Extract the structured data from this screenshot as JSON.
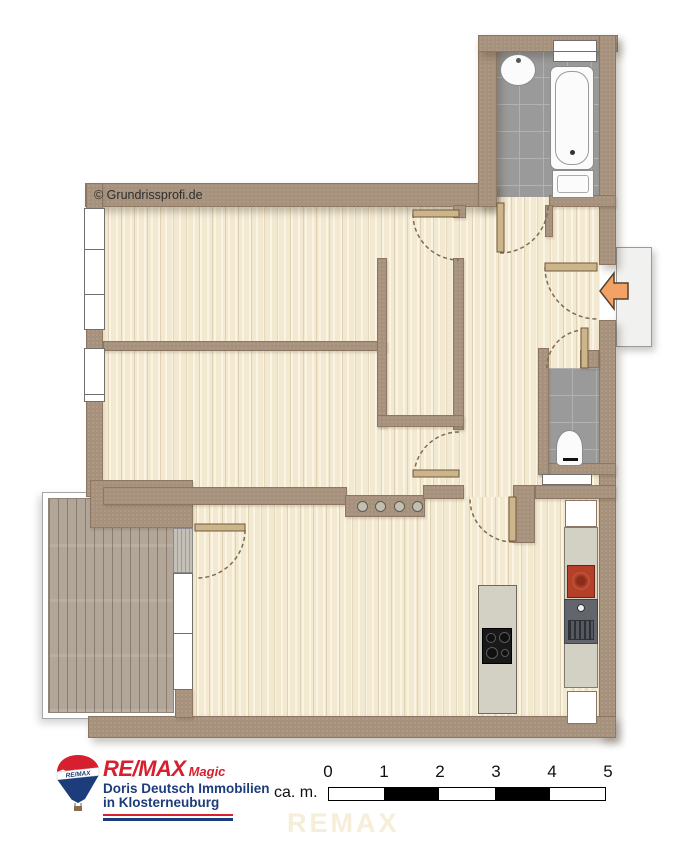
{
  "plan": {
    "copyright_watermark": "© Grundrissprofi.de"
  },
  "footer": {
    "logo": {
      "brand": "RE/MAX",
      "suffix": "Magic",
      "line1": "Doris Deutsch Immobilien",
      "line2": "in Klosterneuburg",
      "balloon_label": "RE/MAX"
    },
    "scale_bar": {
      "unit_label": "ca. m.",
      "tick_labels": [
        "0",
        "1",
        "2",
        "3",
        "4",
        "5"
      ],
      "segment_colors": [
        "#ffffff",
        "#000000",
        "#ffffff",
        "#000000",
        "#ffffff"
      ]
    },
    "background_watermark": "REMAX"
  },
  "colors": {
    "wall": "#a6917c",
    "floor_wood": "#f3e9d1",
    "tile_floor": "#9a9a9a",
    "balcony_deck": "#b1a698",
    "entrance_arrow": "#f2a264",
    "brand_red": "#d6202f",
    "brand_blue": "#1d3c7b",
    "stove_red": "#b5402a"
  },
  "icons": {
    "entrance_arrow": "left-arrow",
    "balloon": "remax-hot-air-balloon",
    "copyright": "copyright-symbol"
  }
}
